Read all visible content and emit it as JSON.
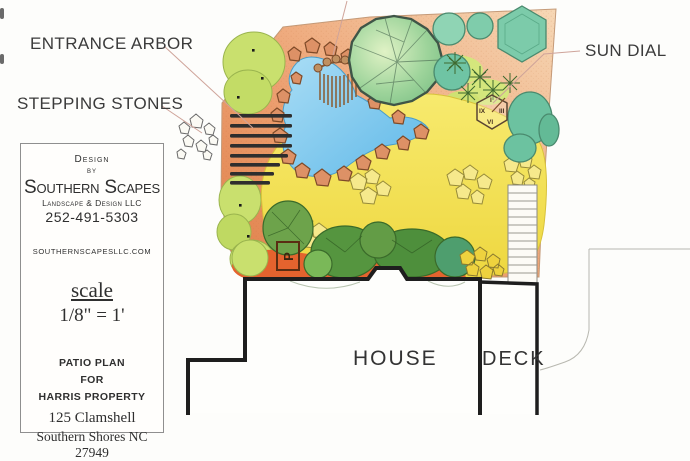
{
  "plan_labels": {
    "entrance_arbor": "ENTRANCE ARBOR",
    "stepping_stones": "STEPPING STONES",
    "sun_dial": "SUN DIAL",
    "house": "HOUSE",
    "deck": "DECK",
    "parking": "P"
  },
  "sundial": {
    "top": "I",
    "left": "IX",
    "right": "III",
    "bottom": "VI"
  },
  "title_block": {
    "design": "Design",
    "by": "by",
    "company": "Southern Scapes",
    "subtitle": "Landscape & Design LLC",
    "phone": "252-491-5303",
    "website": "southernscapesllc.com",
    "scale_label": "scale",
    "scale_value": "1/8\" = 1'",
    "project_line1": "Patio Plan",
    "project_line2": "for",
    "project_line3": "Harris Property",
    "address_line1": "125 Clamshell",
    "address_line2": "Southern Shores NC 27949"
  },
  "colors": {
    "ground_orange": "#e0804a",
    "ground_peach": "#f5d3b1",
    "patio_yellow": "#f2dd4e",
    "pond_blue": "#7cc3ea",
    "tree_green": "#8cc98c",
    "teal_shrub": "#74c8a6",
    "chartreuse_shrub": "#c9e06e",
    "dark_green_shrub": "#55953f",
    "red_orange_bed": "#e4632e",
    "ink": "#2a2a2a",
    "label_gray": "#3b3b3b"
  }
}
